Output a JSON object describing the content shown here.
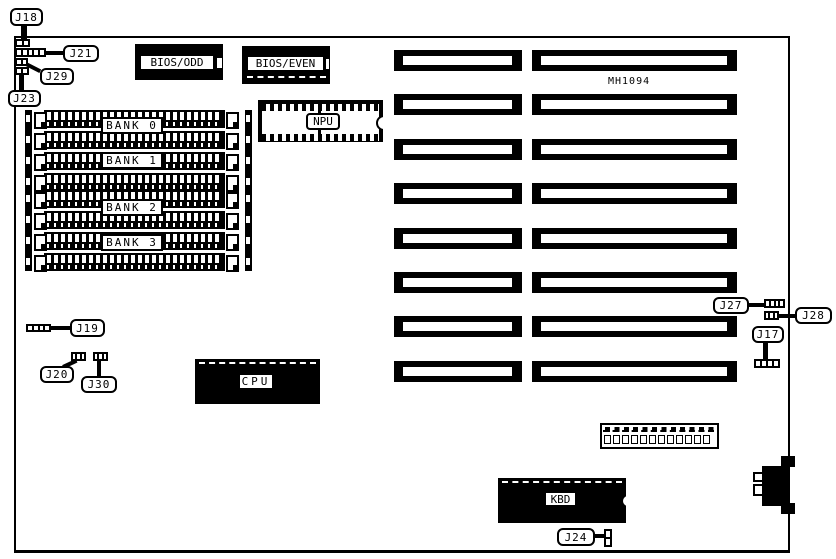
{
  "part_number": "MH1094",
  "colors": {
    "ink": "#000000",
    "paper": "#ffffff"
  },
  "chips": {
    "bios_odd": "BIOS/ODD",
    "bios_even": "BIOS/EVEN",
    "npu": "NPU",
    "cpu": "CPU",
    "kbd": "KBD"
  },
  "callouts": [
    {
      "id": "J18",
      "x": 10,
      "y": 8,
      "w": 33,
      "h": 18
    },
    {
      "id": "J21",
      "x": 63,
      "y": 45,
      "w": 36,
      "h": 17
    },
    {
      "id": "J29",
      "x": 40,
      "y": 68,
      "w": 34,
      "h": 17
    },
    {
      "id": "J23",
      "x": 8,
      "y": 90,
      "w": 33,
      "h": 17
    },
    {
      "id": "J19",
      "x": 70,
      "y": 319,
      "w": 35,
      "h": 18
    },
    {
      "id": "J20",
      "x": 40,
      "y": 366,
      "w": 34,
      "h": 17
    },
    {
      "id": "J30",
      "x": 81,
      "y": 376,
      "w": 36,
      "h": 17
    },
    {
      "id": "J27",
      "x": 713,
      "y": 297,
      "w": 36,
      "h": 17
    },
    {
      "id": "J28",
      "x": 795,
      "y": 307,
      "w": 37,
      "h": 17
    },
    {
      "id": "J17",
      "x": 752,
      "y": 326,
      "w": 32,
      "h": 17
    },
    {
      "id": "J24",
      "x": 557,
      "y": 528,
      "w": 38,
      "h": 18
    }
  ],
  "pointers": [
    {
      "x": 21,
      "y": 24,
      "w": 6,
      "h": 16,
      "r": 0
    },
    {
      "x": 45,
      "y": 51,
      "w": 19,
      "h": 4,
      "r": 0
    },
    {
      "x": 26,
      "y": 62,
      "w": 16,
      "h": 4,
      "r": 27
    },
    {
      "x": 19,
      "y": 75,
      "w": 5,
      "h": 16,
      "r": 0
    },
    {
      "x": 49,
      "y": 326,
      "w": 22,
      "h": 4,
      "r": 0
    },
    {
      "x": 63,
      "y": 365,
      "w": 15,
      "h": 4,
      "r": -25
    },
    {
      "x": 97,
      "y": 361,
      "w": 4,
      "h": 16,
      "r": 0
    },
    {
      "x": 747,
      "y": 303,
      "w": 18,
      "h": 4,
      "r": 0
    },
    {
      "x": 778,
      "y": 314,
      "w": 18,
      "h": 4,
      "r": 0
    },
    {
      "x": 763,
      "y": 342,
      "w": 5,
      "h": 18,
      "r": 0
    },
    {
      "x": 594,
      "y": 534,
      "w": 11,
      "h": 4,
      "r": 0
    }
  ],
  "jumpers": [
    {
      "id": "J18",
      "x": 15,
      "y": 39,
      "w": 15,
      "h": 8,
      "cells": 2,
      "v": false
    },
    {
      "id": "J21",
      "x": 15,
      "y": 48,
      "w": 31,
      "h": 9,
      "cells": 5,
      "v": false
    },
    {
      "id": "J29",
      "x": 15,
      "y": 58,
      "w": 13,
      "h": 8,
      "cells": 2,
      "v": false
    },
    {
      "id": "J23",
      "x": 15,
      "y": 67,
      "w": 14,
      "h": 8,
      "cells": 2,
      "v": false
    },
    {
      "id": "J19",
      "x": 26,
      "y": 324,
      "w": 25,
      "h": 8,
      "cells": 4,
      "v": false
    },
    {
      "id": "J20",
      "x": 71,
      "y": 352,
      "w": 15,
      "h": 9,
      "cells": 3,
      "v": false
    },
    {
      "id": "J30",
      "x": 93,
      "y": 352,
      "w": 15,
      "h": 9,
      "cells": 3,
      "v": false
    },
    {
      "id": "J27",
      "x": 764,
      "y": 299,
      "w": 21,
      "h": 9,
      "cells": 4,
      "v": false
    },
    {
      "id": "J28",
      "x": 764,
      "y": 311,
      "w": 15,
      "h": 9,
      "cells": 3,
      "v": false
    },
    {
      "id": "J17",
      "x": 754,
      "y": 359,
      "w": 26,
      "h": 9,
      "cells": 4,
      "v": false
    },
    {
      "id": "J24",
      "x": 604,
      "y": 529,
      "w": 8,
      "h": 18,
      "cells": 2,
      "v": true
    }
  ],
  "banks": [
    {
      "label": "BANK 0",
      "rows_y": [
        110,
        131
      ],
      "label_y": 117
    },
    {
      "label": "BANK 1",
      "rows_y": [
        152,
        173
      ],
      "label_y": 152
    },
    {
      "label": "BANK 2",
      "rows_y": [
        190,
        211
      ],
      "label_y": 199
    },
    {
      "label": "BANK 3",
      "rows_y": [
        232,
        253
      ],
      "label_y": 234
    }
  ],
  "bank_geometry": {
    "strip_left_x": 25,
    "strip_right_x": 245,
    "strip_groups": [
      [
        110,
        81
      ],
      [
        190,
        81
      ]
    ],
    "clip_left_x": 34,
    "clip_right_x": 226,
    "bar_x": 44,
    "bar_w": 181,
    "label_x": 101
  },
  "slots": {
    "ys": [
      50,
      94,
      139,
      183,
      228,
      272,
      316,
      361
    ],
    "left_x": 394,
    "left_w": 128,
    "right_x": 532,
    "right_w": 205,
    "h": 21
  },
  "power_connector": {
    "pin_count": 12
  }
}
